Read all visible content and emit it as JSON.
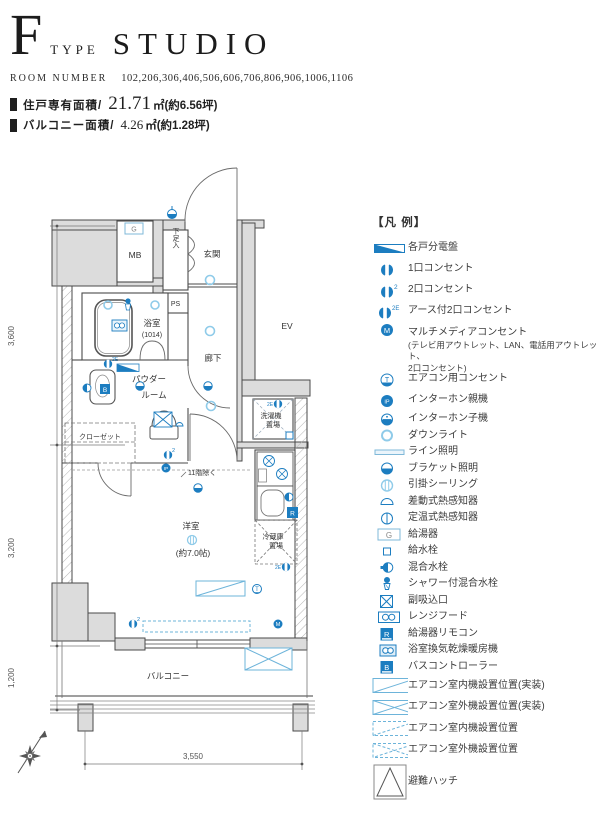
{
  "header": {
    "type_letter": "F",
    "type_word": "TYPE",
    "type_name": "STUDIO",
    "room_number_label": "ROOM NUMBER",
    "room_numbers": "102,206,306,406,506,606,706,806,906,1006,1106",
    "area1_label": "住戸専有面積/",
    "area1_value": "21.71",
    "area1_unit": "㎡(約6.56坪)",
    "area2_label": "バルコニー面積/",
    "area2_value": "4.26",
    "area2_unit": "㎡(約1.28坪)"
  },
  "plan": {
    "rooms": {
      "mb": "MB",
      "shoe": "下足入",
      "ps": "PS",
      "entrance": "玄関",
      "ev": "EV",
      "bathroom": "浴室",
      "bathroom_size": "(1014)",
      "corridor": "廊下",
      "powder1": "パウダー",
      "powder2": "ルーム",
      "closet": "クローゼット",
      "washer1": "洗濯機",
      "washer2": "置場",
      "note_11f": "11階除く",
      "main_room": "洋室",
      "main_room_size": "(約7.0帖)",
      "fridge1": "冷蔵庫",
      "fridge2": "置場",
      "balcony": "バルコニー"
    },
    "dimensions": {
      "d3600": "3,600",
      "d3200": "3,200",
      "d1200": "1,200",
      "d3550": "3,550"
    },
    "symbols": {
      "g": "G",
      "r": "R",
      "b": "B",
      "m": "M",
      "ip": "IP",
      "t": "T",
      "sup2": "2",
      "sup2e": "2E"
    }
  },
  "legend": {
    "title": "【凡 例】",
    "items": [
      {
        "label": "各戸分電盤"
      },
      {
        "label": "1口コンセント"
      },
      {
        "label": "2口コンセント"
      },
      {
        "label": "アース付2口コンセント"
      },
      {
        "label": "マルチメディアコンセント",
        "note1": "(テレビ用アウトレット、LAN、電話用アウトレット、",
        "note2": "2口コンセント)"
      },
      {
        "label": "エアコン用コンセント"
      },
      {
        "label": "インターホン親機"
      },
      {
        "label": "インターホン子機"
      },
      {
        "label": "ダウンライト"
      },
      {
        "label": "ライン照明"
      },
      {
        "label": "ブラケット照明"
      },
      {
        "label": "引掛シーリング"
      },
      {
        "label": "差動式熱感知器"
      },
      {
        "label": "定温式熱感知器"
      },
      {
        "label": "給湯器"
      },
      {
        "label": "給水栓"
      },
      {
        "label": "混合水栓"
      },
      {
        "label": "シャワー付混合水栓"
      },
      {
        "label": "副吸込口"
      },
      {
        "label": "レンジフード"
      },
      {
        "label": "給湯器リモコン"
      },
      {
        "label": "浴室換気乾燥暖房機"
      },
      {
        "label": "バスコントローラー"
      },
      {
        "label": "エアコン室内機設置位置(実装)"
      },
      {
        "label": "エアコン室外機設置位置(実装)"
      },
      {
        "label": "エアコン室内機設置位置"
      },
      {
        "label": "エアコン室外機設置位置"
      },
      {
        "label": "避難ハッチ"
      }
    ]
  },
  "colors": {
    "symbol_blue": "#1c7dc0",
    "light_blue": "#8fcbe9",
    "ac_blue": "#6db4da",
    "wall_gray": "#dcdcdc",
    "line_dark": "#4a4a4a"
  }
}
